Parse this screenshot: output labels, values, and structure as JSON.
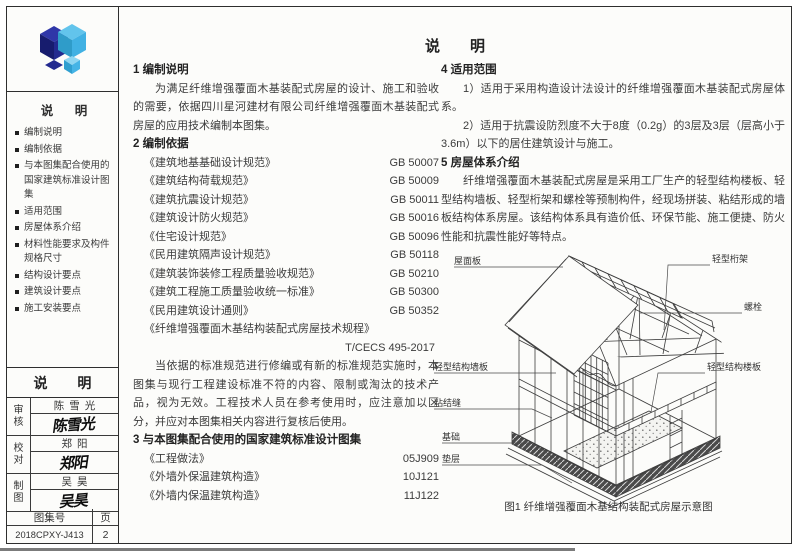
{
  "page": {
    "title": "说　　明"
  },
  "sidebar": {
    "logo_icon": "blue-diamond-cluster",
    "toc_title": "说 明",
    "toc_items": [
      "编制说明",
      "编制依据",
      "与本图集配合使用的国家建筑标准设计图集",
      "适用范围",
      "房屋体系介绍",
      "材料性能要求及构件规格尺寸",
      "结构设计要点",
      "建筑设计要点",
      "施工安装要点"
    ],
    "block_title": "说 明"
  },
  "titleblock": {
    "rows": [
      {
        "role": "审核",
        "name": "陈雪光"
      },
      {
        "role": "校对",
        "name": "郑阳"
      },
      {
        "role": "制图",
        "name": "吴昊"
      }
    ],
    "atlas_label": "图集号",
    "page_label": "页",
    "atlas_no": "2018CPXY-J413",
    "page_no": "2"
  },
  "sections": {
    "s1": {
      "heading": "1 编制说明",
      "body": "为满足纤维增强覆面木基装配式房屋的设计、施工和验收的需要，依据四川星河建材有限公司纤维增强覆面木基装配式房屋的应用技术编制本图集。"
    },
    "s2": {
      "heading": "2 编制依据",
      "standards": [
        {
          "title": "《建筑地基基础设计规范》",
          "code": "GB 50007"
        },
        {
          "title": "《建筑结构荷载规范》",
          "code": "GB 50009"
        },
        {
          "title": "《建筑抗震设计规范》",
          "code": "GB 50011"
        },
        {
          "title": "《建筑设计防火规范》",
          "code": "GB 50016"
        },
        {
          "title": "《住宅设计规范》",
          "code": "GB 50096"
        },
        {
          "title": "《民用建筑隔声设计规范》",
          "code": "GB 50118"
        },
        {
          "title": "《建筑装饰装修工程质量验收规范》",
          "code": "GB 50210"
        },
        {
          "title": "《建筑工程施工质量验收统一标准》",
          "code": "GB 50300"
        },
        {
          "title": "《民用建筑设计通则》",
          "code": "GB 50352"
        },
        {
          "title": "《纤维增强覆面木基结构装配式房屋技术规程》",
          "code": "T/CECS 495-2017"
        }
      ],
      "note": "当依据的标准规范进行修编或有新的标准规范实施时，本图集与现行工程建设标准不符的内容、限制或淘汰的技术产品，视为无效。工程技术人员在参考使用时，应注意加以区分，并应对本图集相关内容进行复核后使用。"
    },
    "s3": {
      "heading": "3 与本图集配合使用的国家建筑标准设计图集",
      "atlases": [
        {
          "title": "《工程做法》",
          "code": "05J909"
        },
        {
          "title": "《外墙外保温建筑构造》",
          "code": "10J121"
        },
        {
          "title": "《外墙内保温建筑构造》",
          "code": "11J122"
        }
      ]
    },
    "s4": {
      "heading": "4 适用范围",
      "items": [
        "1）适用于采用构造设计法设计的纤维增强覆面木基装配式房屋体系。",
        "2）适用于抗震设防烈度不大于8度（0.2g）的3层及3层（层高小于3.6m）以下的居住建筑设计与施工。"
      ]
    },
    "s5": {
      "heading": "5 房屋体系介绍",
      "body": "纤维增强覆面木基装配式房屋是采用工厂生产的轻型结构楼板、轻型结构墙板、轻型桁架和螺栓等预制构件，经现场拼装、粘结形成的墙板结构体系房屋。该结构体系具有造价低、环保节能、施工便捷、防火性能和抗震性能好等特点。"
    }
  },
  "figure": {
    "caption": "图1 纤维增强覆面木基结构装配式房屋示意图",
    "labels": {
      "roof_panel": "屋面板",
      "light_truss": "轻型桁架",
      "bolt": "螺栓",
      "floor_panel": "轻型结构楼板",
      "wall_panel": "轻型结构墙板",
      "bond_joint": "粘结缝",
      "foundation": "基础",
      "bedding_layer": "垫层"
    }
  },
  "colors": {
    "logo_dark": "#1a1f71",
    "logo_light": "#41b1e3",
    "line": "#2e2e2e"
  }
}
